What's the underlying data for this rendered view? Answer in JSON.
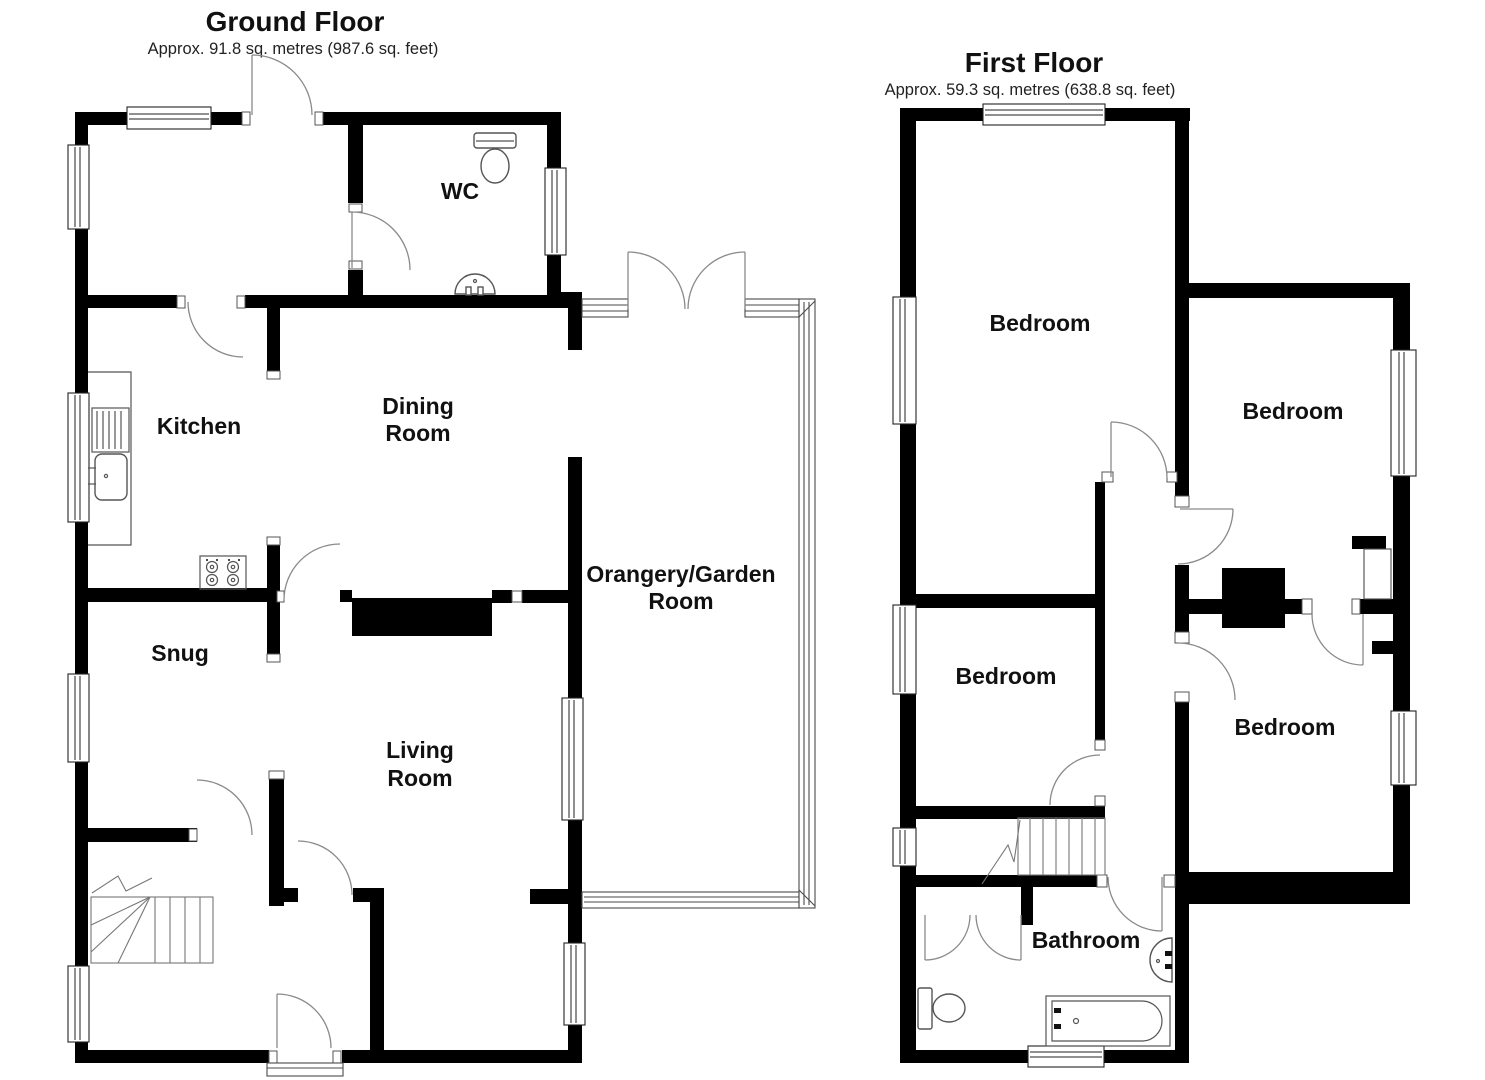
{
  "ground_floor": {
    "title": "Ground Floor",
    "subtitle": "Approx. 91.8 sq. metres (987.6 sq. feet)",
    "rooms": {
      "wc": "WC",
      "kitchen": "Kitchen",
      "dining_room": [
        "Dining",
        "Room"
      ],
      "snug": "Snug",
      "living_room": [
        "Living",
        "Room"
      ],
      "orangery": [
        "Orangery/Garden",
        "Room"
      ]
    }
  },
  "first_floor": {
    "title": "First Floor",
    "subtitle": "Approx. 59.3 sq. metres (638.8 sq. feet)",
    "rooms": {
      "bedroom_front": "Bedroom",
      "bedroom_right": "Bedroom",
      "bedroom_middle": "Bedroom",
      "bedroom_back_right": "Bedroom",
      "bathroom": "Bathroom"
    }
  },
  "colors": {
    "wall": "#000000",
    "background": "#ffffff",
    "fixture_line": "#666666"
  }
}
